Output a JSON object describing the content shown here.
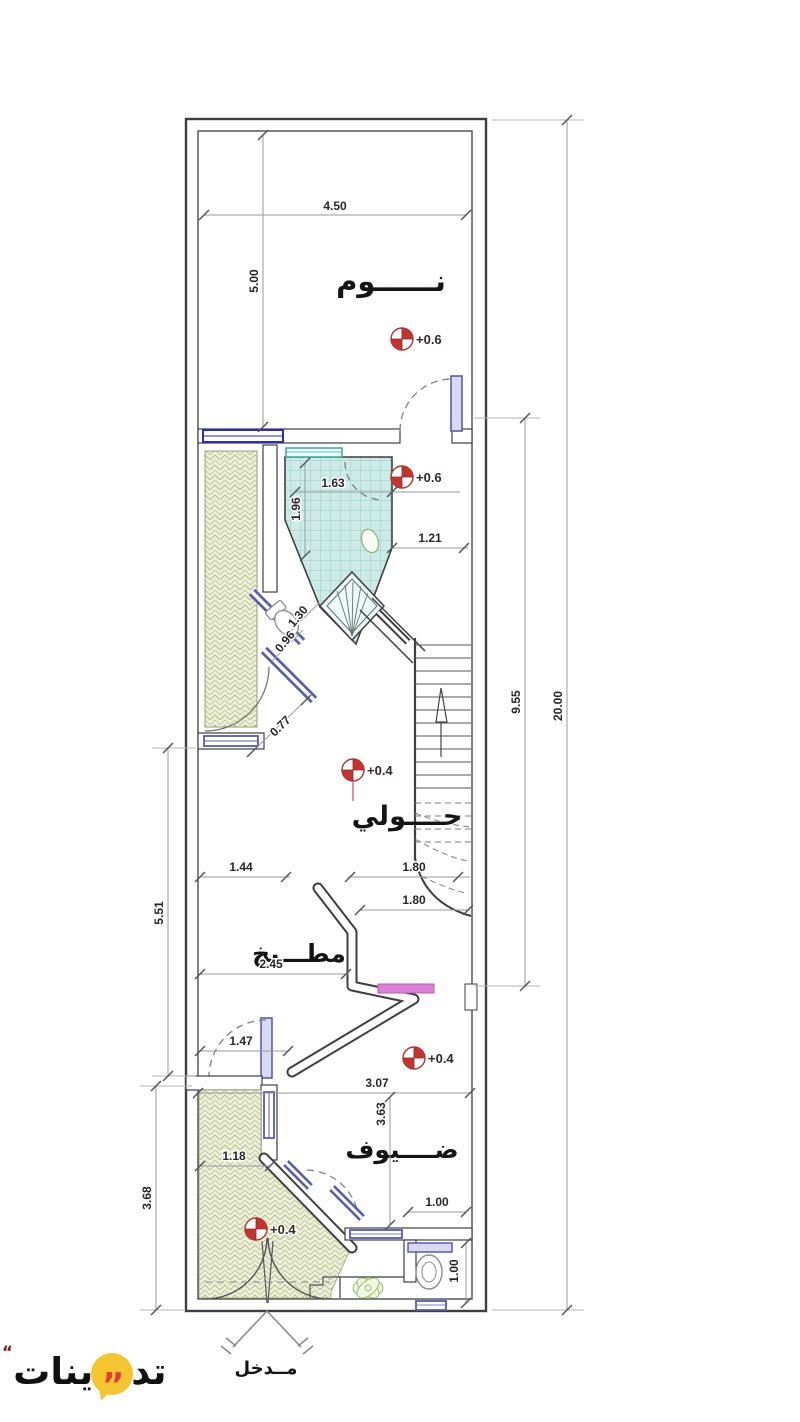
{
  "page": {
    "type": "architectural-floor-plan",
    "language": "Arabic"
  },
  "logo": {
    "part_right": "تد",
    "part_left": "ينات",
    "quotes": ",,",
    "mark": ",,"
  },
  "rooms": {
    "bedroom": "نــــــوم",
    "hall": "حــــولي",
    "kitchen": "مطـــبخ",
    "guests": "ضــــيوف",
    "entrance": "مــدخل"
  },
  "levels": {
    "bedroom": "+0.6",
    "bathroom": "+0.6",
    "hall": "+0.4",
    "dining": "+0.4",
    "entrance": "+0.4"
  },
  "dims": {
    "bedroom_width": "4.50",
    "bedroom_height": "5.00",
    "bath_width": "1.63",
    "bath_height": "1.96",
    "bath_side": "1.21",
    "diag_a": "1.30",
    "diag_b": "0.96",
    "diag_c": "0.77",
    "kitchen_left": "1.44",
    "landing_a": "1.80",
    "landing_b": "1.80",
    "left_mid": "5.51",
    "kitchen_width": "2.45",
    "kitchen_door": "1.47",
    "guests_width": "3.07",
    "guests_height": "3.63",
    "entry_width": "1.18",
    "wc_width": "1.00",
    "wc_height": "1.00",
    "left_bottom": "3.68",
    "stairs_span": "9.55",
    "total_length": "20.00"
  },
  "colors": {
    "wall": "#3f3f42",
    "dim_line": "#9a9aa2",
    "frame_purple": "#5b5bad",
    "window_blue": "#2b2bbf",
    "tile_fill": "#cdeae6",
    "tile_grid": "#8fd0c9",
    "hatch_fill": "#eef0dc",
    "hatch_stroke": "#b9c492",
    "marker_red": "#c3342f",
    "counter_pink": "#d981d9",
    "logo_yellow": "#f5c431",
    "logo_red": "#e23b3b"
  }
}
